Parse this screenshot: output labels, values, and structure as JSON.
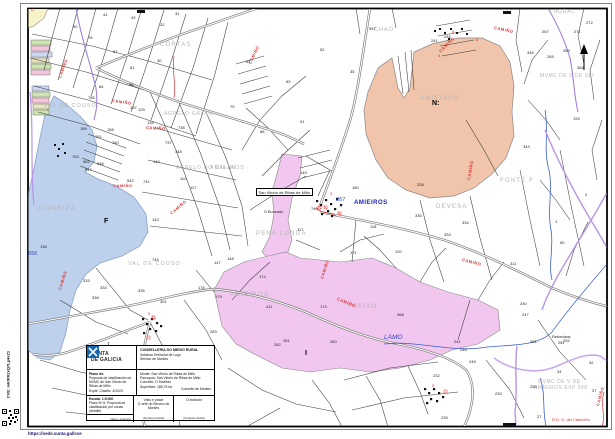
{
  "page": {
    "cve_vertical": "CVE: mK9tR2xQ7Lp4sZ1",
    "footer_url": "https://sede.xunta.gal/cve"
  },
  "title_block": {
    "org_line1": "XUNTA",
    "org_line2": "DE GALICIA",
    "dept1": "CONSELLERÍA DO MEDIO RURAL",
    "dept2": "Xefatura Territorial de Lugo",
    "dept3": "Servizo de Montes",
    "plano_label": "Plano de:",
    "plano_text": "Proposta de clasificación do MVMC de San Vitorio de Ribas de Miño",
    "plano_sub": "Expte. Clasific. 4/2023",
    "monte": "Monte: San Vitorio de Ribas de Miño",
    "parroquia": "Parroquia: San Vitorio de Ribas de Miño",
    "concello": "Concello: O Saviñao",
    "superficie": "Superficie: 186,75 ha",
    "consello": "Consello de Montes",
    "escala": "Escala: 1:5.000",
    "plano_num": "Plano Nº 6: Proposta de clasificación por zonas (detalle)",
    "visto": "Visto e prace",
    "visto_sub": "O xefe do Servizo de Montes",
    "sinatura1": "(Sinatura dixital)",
    "instrutor": "O instrutor",
    "sinatura2": "(Sinatura dixital)",
    "data_sinatura": "(data e sinatura)"
  },
  "map": {
    "boxed_label": "San Vitorio de Ribas de Miño",
    "place_labels": [
      {
        "t": "CORTAS",
        "x": 160,
        "y": 42
      },
      {
        "t": "VAL DE COUSO",
        "x": 44,
        "y": 104,
        "s": 5.5,
        "ls": 1
      },
      {
        "t": "AGRELO GALAN",
        "x": 164,
        "y": 112,
        "s": 5,
        "ls": 0.8
      },
      {
        "t": "AGRELO DO CALAN",
        "x": 176,
        "y": 166,
        "s": 5,
        "ls": 0.8
      },
      {
        "t": "CHAO",
        "x": 374,
        "y": 28,
        "s": 5.5,
        "ls": 1
      },
      {
        "t": "AGRAL",
        "x": 554,
        "y": 10,
        "s": 5,
        "ls": 0.8
      },
      {
        "t": "AMIEIROS",
        "x": 420,
        "y": 96,
        "italic": true
      },
      {
        "t": "MVMC DE V DE SEI",
        "x": 540,
        "y": 74,
        "s": 5,
        "ls": 0.5
      },
      {
        "t": "FONTE F",
        "x": 500,
        "y": 178
      },
      {
        "t": "DEVESA",
        "x": 436,
        "y": 204
      },
      {
        "t": "AMIEIROS",
        "x": 210,
        "y": 166,
        "s": 5.5,
        "ls": 1
      },
      {
        "t": "PENA LONGA",
        "x": 256,
        "y": 231
      },
      {
        "t": "ALVARIZA",
        "x": 38,
        "y": 206
      },
      {
        "t": "VAL DE COUSO",
        "x": 128,
        "y": 262,
        "s": 5.5,
        "ls": 1
      },
      {
        "t": "AMIEIROS",
        "x": 230,
        "y": 292
      },
      {
        "t": "FREIXO",
        "x": 348,
        "y": 304
      },
      {
        "t": "MVMC DE V DE",
        "x": 538,
        "y": 380,
        "s": 5,
        "ls": 0.5
      },
      {
        "t": "AMIEIROS EXP 598",
        "x": 534,
        "y": 386,
        "s": 5,
        "ls": 0.5
      }
    ],
    "bold_marks": [
      {
        "t": "F",
        "x": 104,
        "y": 218
      },
      {
        "t": "N:",
        "x": 432,
        "y": 100
      },
      {
        "t": "I",
        "x": 305,
        "y": 350
      }
    ],
    "hydro_labels": [
      {
        "t": "656",
        "x": 28,
        "y": 252
      },
      {
        "t": "857",
        "x": 336,
        "y": 198
      },
      {
        "t": "LAMO",
        "x": 384,
        "y": 335,
        "s": 6.5
      }
    ],
    "blue_bold_labels": [
      {
        "t": "AMIEIROS",
        "x": 354,
        "y": 200
      }
    ],
    "small_texts": [
      {
        "t": "Rebordaos",
        "x": 552,
        "y": 336
      },
      {
        "t": "254",
        "x": 558,
        "y": 342
      },
      {
        "t": "O Bouzado",
        "x": 264,
        "y": 211
      }
    ],
    "camino_labels": [
      {
        "t": "CAMIÑO",
        "x": 60,
        "y": 76,
        "r": -70
      },
      {
        "t": "CAMIÑO",
        "x": 146,
        "y": 126,
        "r": 3
      },
      {
        "t": "CAMIÑO",
        "x": 250,
        "y": 62,
        "r": -65
      },
      {
        "t": "CAMIÑO",
        "x": 112,
        "y": 99,
        "r": 8
      },
      {
        "t": "CAMIÑO",
        "x": 494,
        "y": 26,
        "r": 12
      },
      {
        "t": "CAMIÑO",
        "x": 440,
        "y": 50,
        "r": -45
      },
      {
        "t": "CAMIÑO",
        "x": 322,
        "y": 277,
        "r": -72
      },
      {
        "t": "CAMIÑO",
        "x": 337,
        "y": 297,
        "r": 22
      },
      {
        "t": "CAMIÑO",
        "x": 113,
        "y": 184,
        "r": 0
      },
      {
        "t": "CAMIÑO",
        "x": 171,
        "y": 212,
        "r": -40
      },
      {
        "t": "CAMIÑO",
        "x": 60,
        "y": 288,
        "r": -72
      },
      {
        "t": "CAMIÑO",
        "x": 469,
        "y": 178,
        "r": -80
      },
      {
        "t": "CAMIÑO",
        "x": 462,
        "y": 258,
        "r": 14
      },
      {
        "t": "CAMIÑO",
        "x": 598,
        "y": 404,
        "r": -75
      }
    ],
    "red_texts": [
      {
        "t": "G",
        "x": 31,
        "y": 8
      },
      {
        "t": "R.D. G. del Cabeciño",
        "x": 552,
        "y": 418
      },
      {
        "t": "8",
        "x": 452,
        "y": 30
      },
      {
        "t": "6",
        "x": 476,
        "y": 38
      },
      {
        "t": "4",
        "x": 438,
        "y": 54
      },
      {
        "t": "3",
        "x": 330,
        "y": 192
      },
      {
        "t": "9",
        "x": 148,
        "y": 312
      },
      {
        "t": "5",
        "x": 432,
        "y": 384
      }
    ],
    "parcel_numbers": [
      {
        "t": "785",
        "x": 88,
        "y": 96
      },
      {
        "t": "761",
        "x": 95,
        "y": 135
      },
      {
        "t": "740",
        "x": 112,
        "y": 141
      },
      {
        "t": "763",
        "x": 72,
        "y": 155
      },
      {
        "t": "562",
        "x": 83,
        "y": 160
      },
      {
        "t": "547",
        "x": 85,
        "y": 168
      },
      {
        "t": "546",
        "x": 97,
        "y": 162
      },
      {
        "t": "542",
        "x": 127,
        "y": 179
      },
      {
        "t": "741",
        "x": 143,
        "y": 180
      },
      {
        "t": "159",
        "x": 80,
        "y": 127
      },
      {
        "t": "158",
        "x": 107,
        "y": 128
      },
      {
        "t": "137",
        "x": 130,
        "y": 106
      },
      {
        "t": "129",
        "x": 138,
        "y": 108
      },
      {
        "t": "134",
        "x": 147,
        "y": 121
      },
      {
        "t": "140",
        "x": 153,
        "y": 160
      },
      {
        "t": "737",
        "x": 165,
        "y": 141
      },
      {
        "t": "738",
        "x": 178,
        "y": 126
      },
      {
        "t": "448",
        "x": 175,
        "y": 150
      },
      {
        "t": "111",
        "x": 180,
        "y": 177
      },
      {
        "t": "117",
        "x": 190,
        "y": 186
      },
      {
        "t": "50",
        "x": 73,
        "y": 25
      },
      {
        "t": "78",
        "x": 88,
        "y": 36
      },
      {
        "t": "41",
        "x": 103,
        "y": 13
      },
      {
        "t": "43",
        "x": 131,
        "y": 16
      },
      {
        "t": "31",
        "x": 175,
        "y": 12
      },
      {
        "t": "32",
        "x": 160,
        "y": 23
      },
      {
        "t": "67",
        "x": 113,
        "y": 50
      },
      {
        "t": "81",
        "x": 130,
        "y": 66
      },
      {
        "t": "30",
        "x": 157,
        "y": 59
      },
      {
        "t": "84",
        "x": 99,
        "y": 85
      },
      {
        "t": "86",
        "x": 129,
        "y": 83
      },
      {
        "t": "62",
        "x": 246,
        "y": 60
      },
      {
        "t": "63",
        "x": 286,
        "y": 80
      },
      {
        "t": "52",
        "x": 320,
        "y": 48
      },
      {
        "t": "35",
        "x": 350,
        "y": 70
      },
      {
        "t": "88",
        "x": 260,
        "y": 130
      },
      {
        "t": "91",
        "x": 300,
        "y": 120
      },
      {
        "t": "75",
        "x": 230,
        "y": 105
      },
      {
        "t": "557",
        "x": 369,
        "y": 27
      },
      {
        "t": "241",
        "x": 431,
        "y": 39
      },
      {
        "t": "246",
        "x": 444,
        "y": 35
      },
      {
        "t": "267",
        "x": 542,
        "y": 30
      },
      {
        "t": "272",
        "x": 586,
        "y": 21
      },
      {
        "t": "271",
        "x": 574,
        "y": 30
      },
      {
        "t": "345",
        "x": 527,
        "y": 51
      },
      {
        "t": "265",
        "x": 547,
        "y": 55
      },
      {
        "t": "269",
        "x": 563,
        "y": 49
      },
      {
        "t": "364",
        "x": 577,
        "y": 66
      },
      {
        "t": "193",
        "x": 573,
        "y": 117
      },
      {
        "t": "149",
        "x": 300,
        "y": 171
      },
      {
        "t": "740",
        "x": 311,
        "y": 207
      },
      {
        "t": "117",
        "x": 297,
        "y": 228
      },
      {
        "t": "171",
        "x": 350,
        "y": 251
      },
      {
        "t": "335",
        "x": 415,
        "y": 214
      },
      {
        "t": "328",
        "x": 417,
        "y": 183
      },
      {
        "t": "180",
        "x": 352,
        "y": 186
      },
      {
        "t": "118",
        "x": 370,
        "y": 225
      },
      {
        "t": "120",
        "x": 395,
        "y": 250
      },
      {
        "t": "148",
        "x": 227,
        "y": 257
      },
      {
        "t": "147",
        "x": 214,
        "y": 261
      },
      {
        "t": "174",
        "x": 259,
        "y": 275
      },
      {
        "t": "178",
        "x": 198,
        "y": 286
      },
      {
        "t": "179",
        "x": 215,
        "y": 295
      },
      {
        "t": "173",
        "x": 320,
        "y": 305
      },
      {
        "t": "280",
        "x": 330,
        "y": 340
      },
      {
        "t": "411",
        "x": 266,
        "y": 305
      },
      {
        "t": "281",
        "x": 283,
        "y": 339
      },
      {
        "t": "282",
        "x": 274,
        "y": 343
      },
      {
        "t": "283",
        "x": 210,
        "y": 330
      },
      {
        "t": "286",
        "x": 188,
        "y": 352
      },
      {
        "t": "301",
        "x": 160,
        "y": 300
      },
      {
        "t": "368",
        "x": 397,
        "y": 313
      },
      {
        "t": "240",
        "x": 520,
        "y": 302
      },
      {
        "t": "247",
        "x": 522,
        "y": 313
      },
      {
        "t": "241",
        "x": 454,
        "y": 340
      },
      {
        "t": "246",
        "x": 460,
        "y": 348
      },
      {
        "t": "245",
        "x": 469,
        "y": 360
      },
      {
        "t": "232",
        "x": 433,
        "y": 374
      },
      {
        "t": "233",
        "x": 495,
        "y": 392
      },
      {
        "t": "250",
        "x": 530,
        "y": 385
      },
      {
        "t": "251",
        "x": 530,
        "y": 340
      },
      {
        "t": "252",
        "x": 563,
        "y": 339
      },
      {
        "t": "239",
        "x": 441,
        "y": 416
      },
      {
        "t": "34",
        "x": 557,
        "y": 370
      },
      {
        "t": "32",
        "x": 589,
        "y": 361
      },
      {
        "t": "27",
        "x": 537,
        "y": 415
      },
      {
        "t": "37",
        "x": 592,
        "y": 389
      },
      {
        "t": "138",
        "x": 40,
        "y": 245
      },
      {
        "t": "333",
        "x": 83,
        "y": 279
      },
      {
        "t": "334",
        "x": 100,
        "y": 286
      },
      {
        "t": "338",
        "x": 92,
        "y": 296
      },
      {
        "t": "335",
        "x": 138,
        "y": 289
      },
      {
        "t": "143",
        "x": 152,
        "y": 218
      },
      {
        "t": "744",
        "x": 152,
        "y": 258
      },
      {
        "t": "343",
        "x": 523,
        "y": 145
      },
      {
        "t": "334",
        "x": 462,
        "y": 221
      },
      {
        "t": "333",
        "x": 444,
        "y": 233
      },
      {
        "t": "311",
        "x": 510,
        "y": 262
      },
      {
        "t": "2",
        "x": 585,
        "y": 193
      },
      {
        "t": "1",
        "x": 555,
        "y": 220
      },
      {
        "t": "50",
        "x": 560,
        "y": 241
      }
    ],
    "colors": {
      "water": "#bdd0ec",
      "pink_zone": "#f2c7ef",
      "salmon_zone": "#f1c5ab",
      "yellow_parcel": "#f7f3c9",
      "purple_boundary": "#9f7fd8",
      "red_annotation": "#d43030",
      "place_label_gray": "#b5b5b5",
      "hydro_blue": "#2b3fd0"
    }
  }
}
